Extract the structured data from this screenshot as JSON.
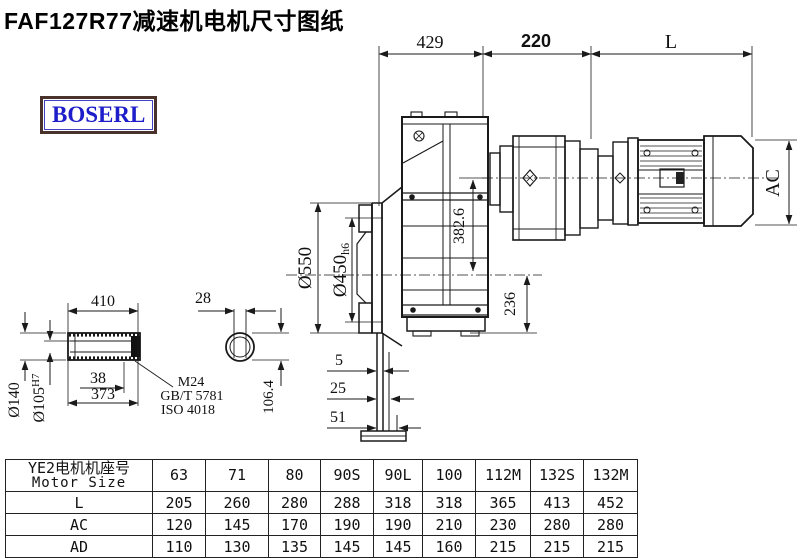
{
  "title": "FAF127R77减速机电机尺寸图纸",
  "logo": {
    "text": "BOSERL"
  },
  "dims": {
    "width_429": "429",
    "width_220": "220",
    "width_L": "L",
    "height_AC": "AC",
    "offset_382_6": "382.6",
    "height_236": "236",
    "dia_550": "Ø550",
    "dia_450": "Ø450",
    "dia_450_tol": "h6",
    "foot_5": "5",
    "foot_25": "25",
    "foot_51": "51",
    "shaft_410": "410",
    "key_28": "28",
    "dia_140": "Ø140",
    "dia_105": "Ø105",
    "dia_105_tol": "H7",
    "key_38": "38",
    "len_373": "373",
    "thread": "M24",
    "std_gb": "GB/T 5781",
    "std_iso": "ISO 4018",
    "flat_106_4": "106.4"
  },
  "table": {
    "header_cn": "YE2电机机座号",
    "header_en": "Motor Size",
    "columns": [
      "63",
      "71",
      "80",
      "90S",
      "90L",
      "100",
      "112M",
      "132S",
      "132M"
    ],
    "rows": [
      {
        "label": "L",
        "values": [
          "205",
          "260",
          "280",
          "288",
          "318",
          "318",
          "365",
          "413",
          "452"
        ]
      },
      {
        "label": "AC",
        "values": [
          "120",
          "145",
          "170",
          "190",
          "190",
          "210",
          "230",
          "280",
          "280"
        ]
      },
      {
        "label": "AD",
        "values": [
          "110",
          "130",
          "135",
          "145",
          "145",
          "160",
          "215",
          "215",
          "215"
        ]
      }
    ]
  },
  "colors": {
    "line": "#1a1a1a",
    "logo_text": "#1d1dc9",
    "logo_border": "#4a322c",
    "background": "#ffffff"
  }
}
